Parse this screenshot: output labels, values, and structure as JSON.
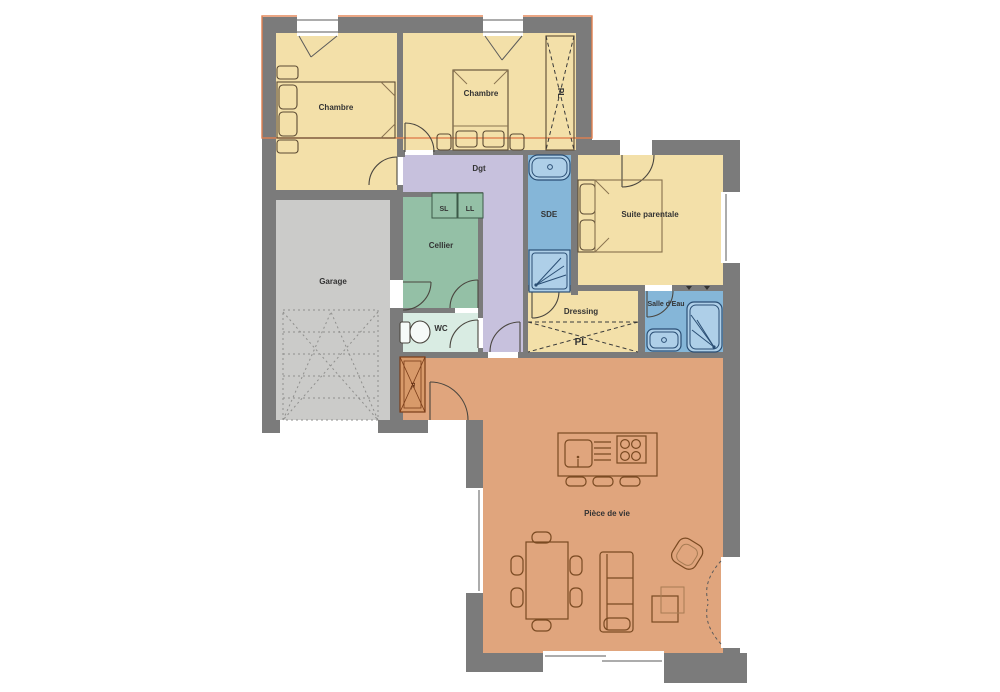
{
  "plan": {
    "colors": {
      "wall": "#7b7b7b",
      "bedroom_fill": "#f3e0a9",
      "garage_fill": "#cbcbc9",
      "cellier_fill": "#94c0a6",
      "wc_fill": "#d9ece3",
      "hallway_fill": "#c7c1dd",
      "bathroom_fill": "#85b6d8",
      "living_fill": "#e0a57d",
      "entry_closet_fill": "#d89a6a",
      "upper_floor_outline": "#e0814f",
      "fixture_fill": "#aecfe8",
      "fixture_stroke": "#2a4e74"
    },
    "rooms": {
      "chambre1": {
        "label": "Chambre"
      },
      "chambre2": {
        "label": "Chambre"
      },
      "closet_top": {
        "label": "PL"
      },
      "hallway": {
        "label": "Dgt"
      },
      "sde": {
        "label": "SDE"
      },
      "suite": {
        "label": "Suite parentale"
      },
      "cellier": {
        "label": "Cellier"
      },
      "garage": {
        "label": "Garage"
      },
      "wc": {
        "label": "WC"
      },
      "dressing": {
        "label": "Dressing"
      },
      "dressing_closet": {
        "label": "PL"
      },
      "salle_eau": {
        "label": "Salle d'Eau"
      },
      "entry_closet": {
        "label": "PL"
      },
      "living": {
        "label": "Pièce de vie"
      }
    },
    "appliances": {
      "seche_linge": "SL",
      "lave_linge": "LL"
    }
  }
}
